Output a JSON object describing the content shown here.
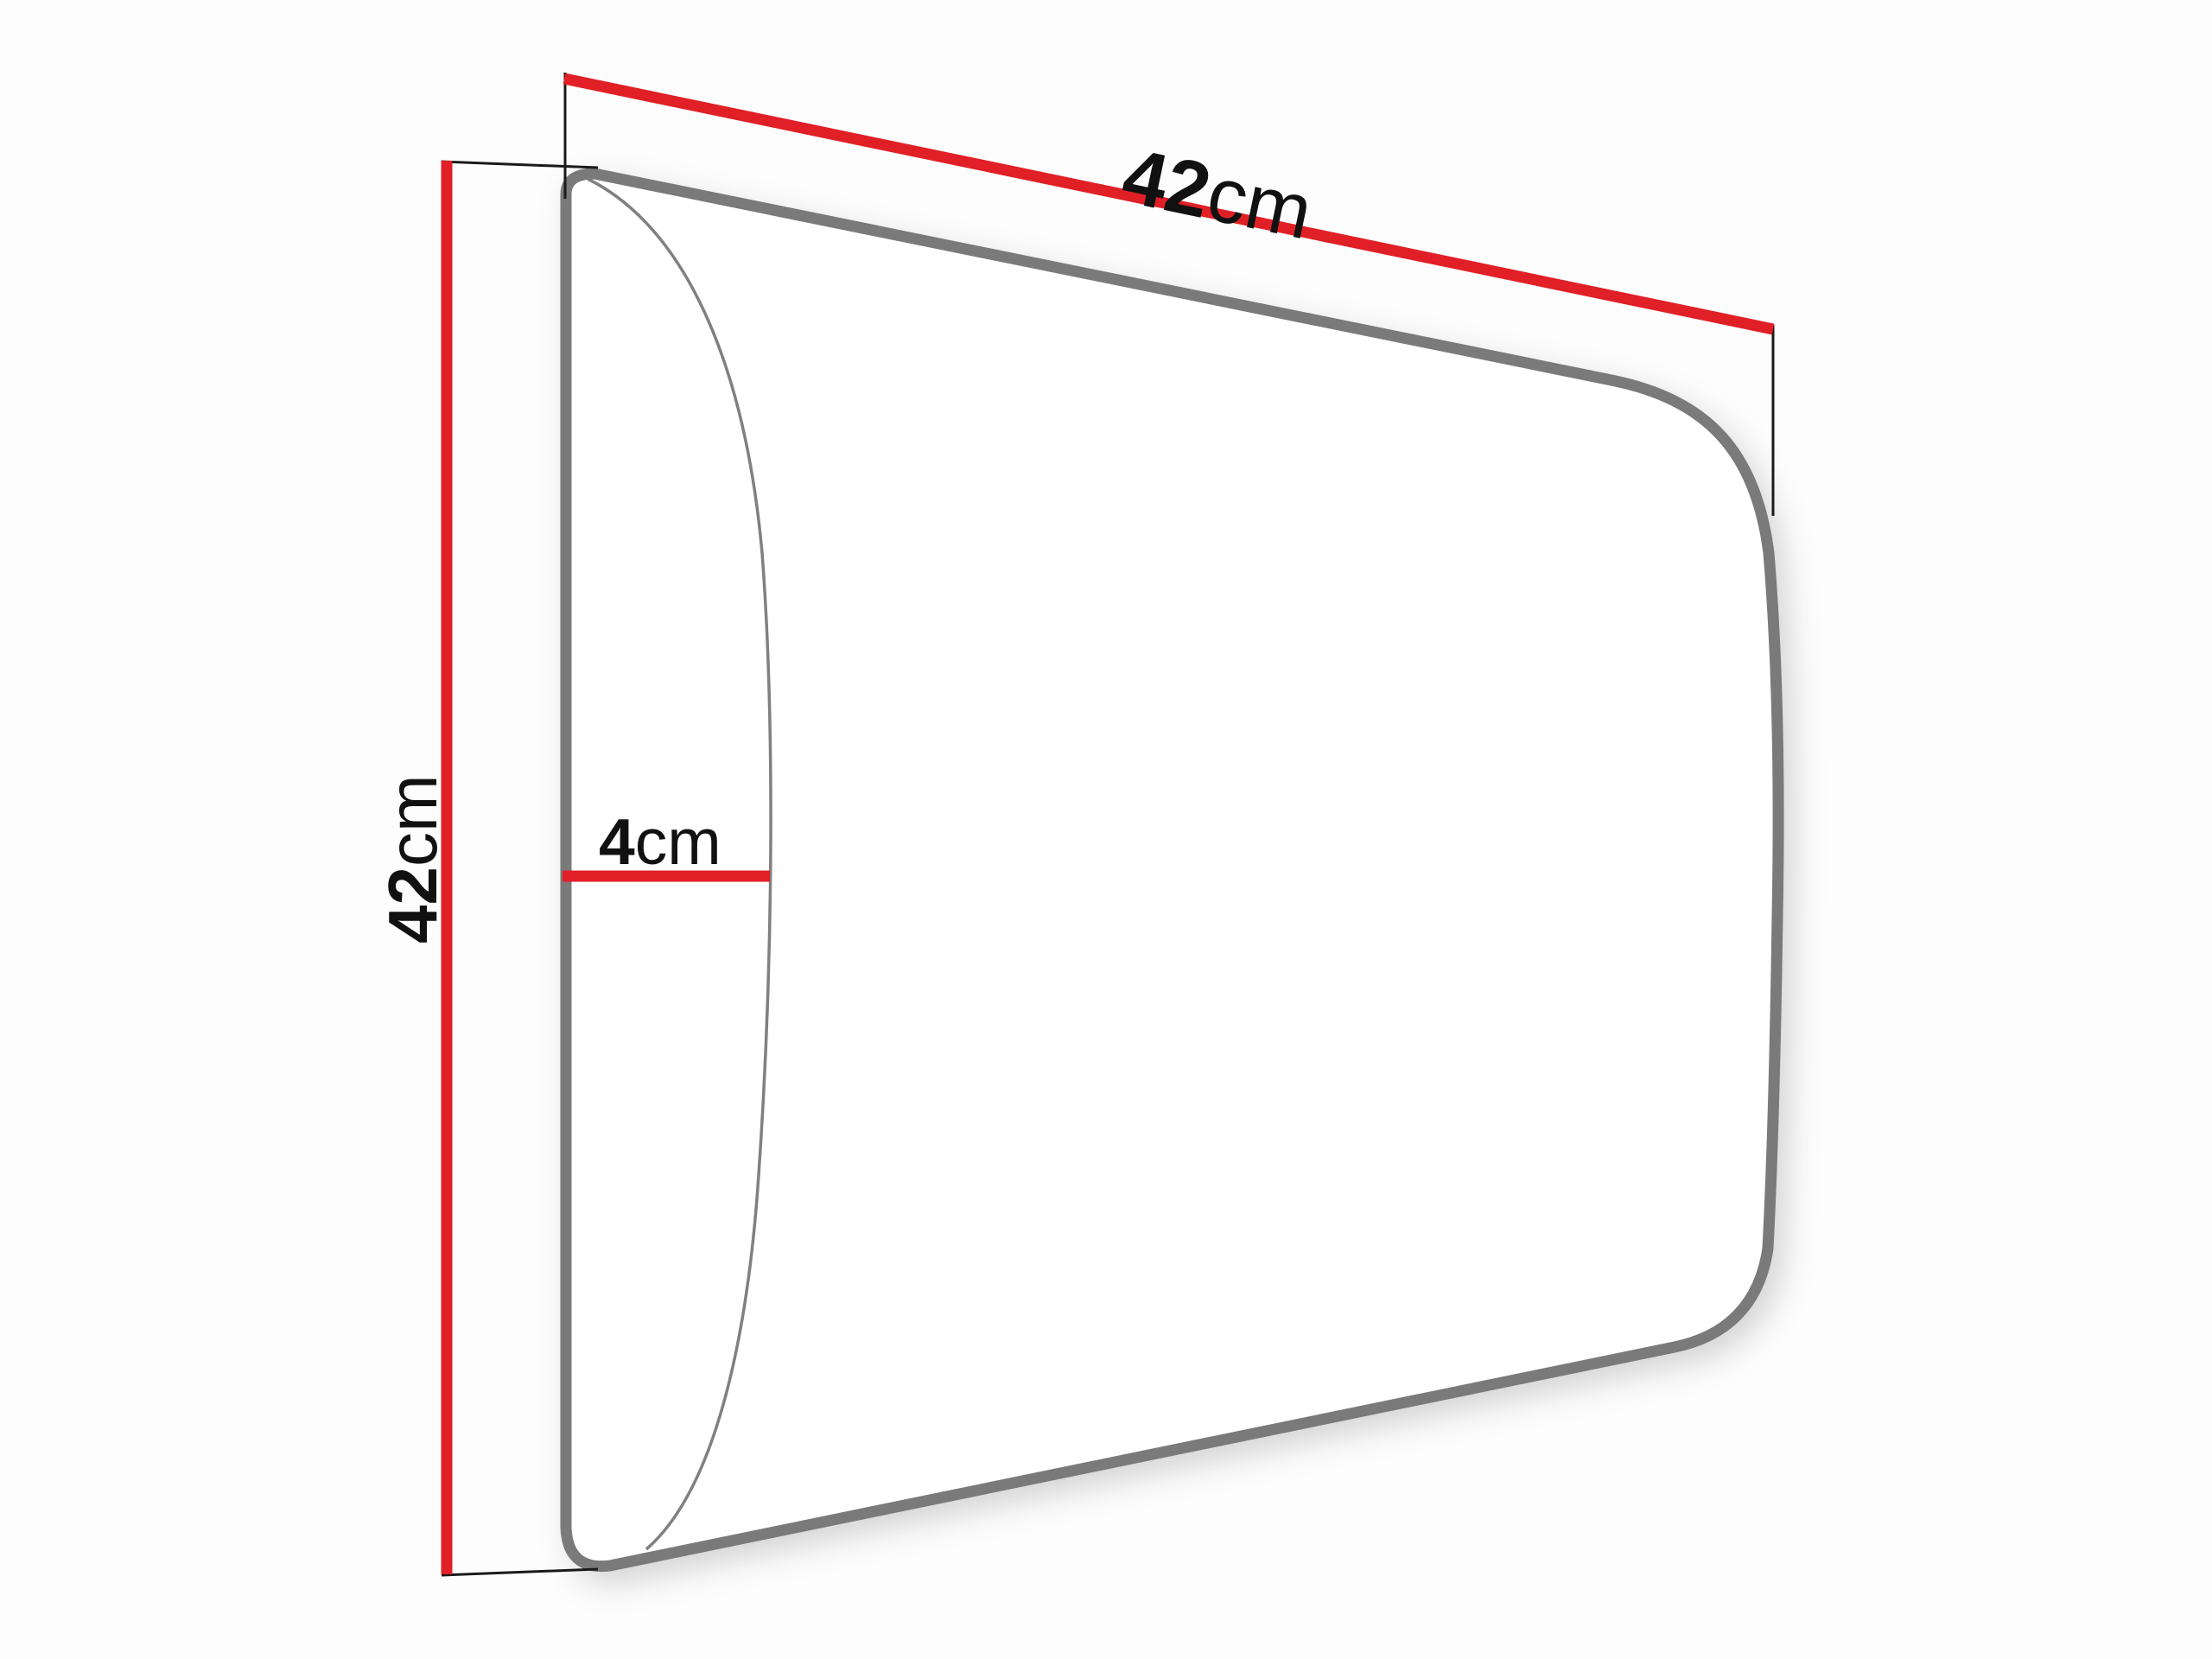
{
  "diagram": {
    "kind": "panel-dimension-diagram",
    "colors": {
      "dimension_line": "#e11f26",
      "panel_outline": "#7a7a7a",
      "front_edge_line": "#808080",
      "extension_line": "#1a1a1a",
      "label_text": "#111111",
      "background": "#fdfdfd",
      "panel_fill": "#ffffff"
    },
    "dimensions": {
      "width": {
        "value": "42",
        "unit": "cm"
      },
      "height": {
        "value": "42",
        "unit": "cm"
      },
      "depth": {
        "value": "4",
        "unit": "cm"
      }
    }
  }
}
